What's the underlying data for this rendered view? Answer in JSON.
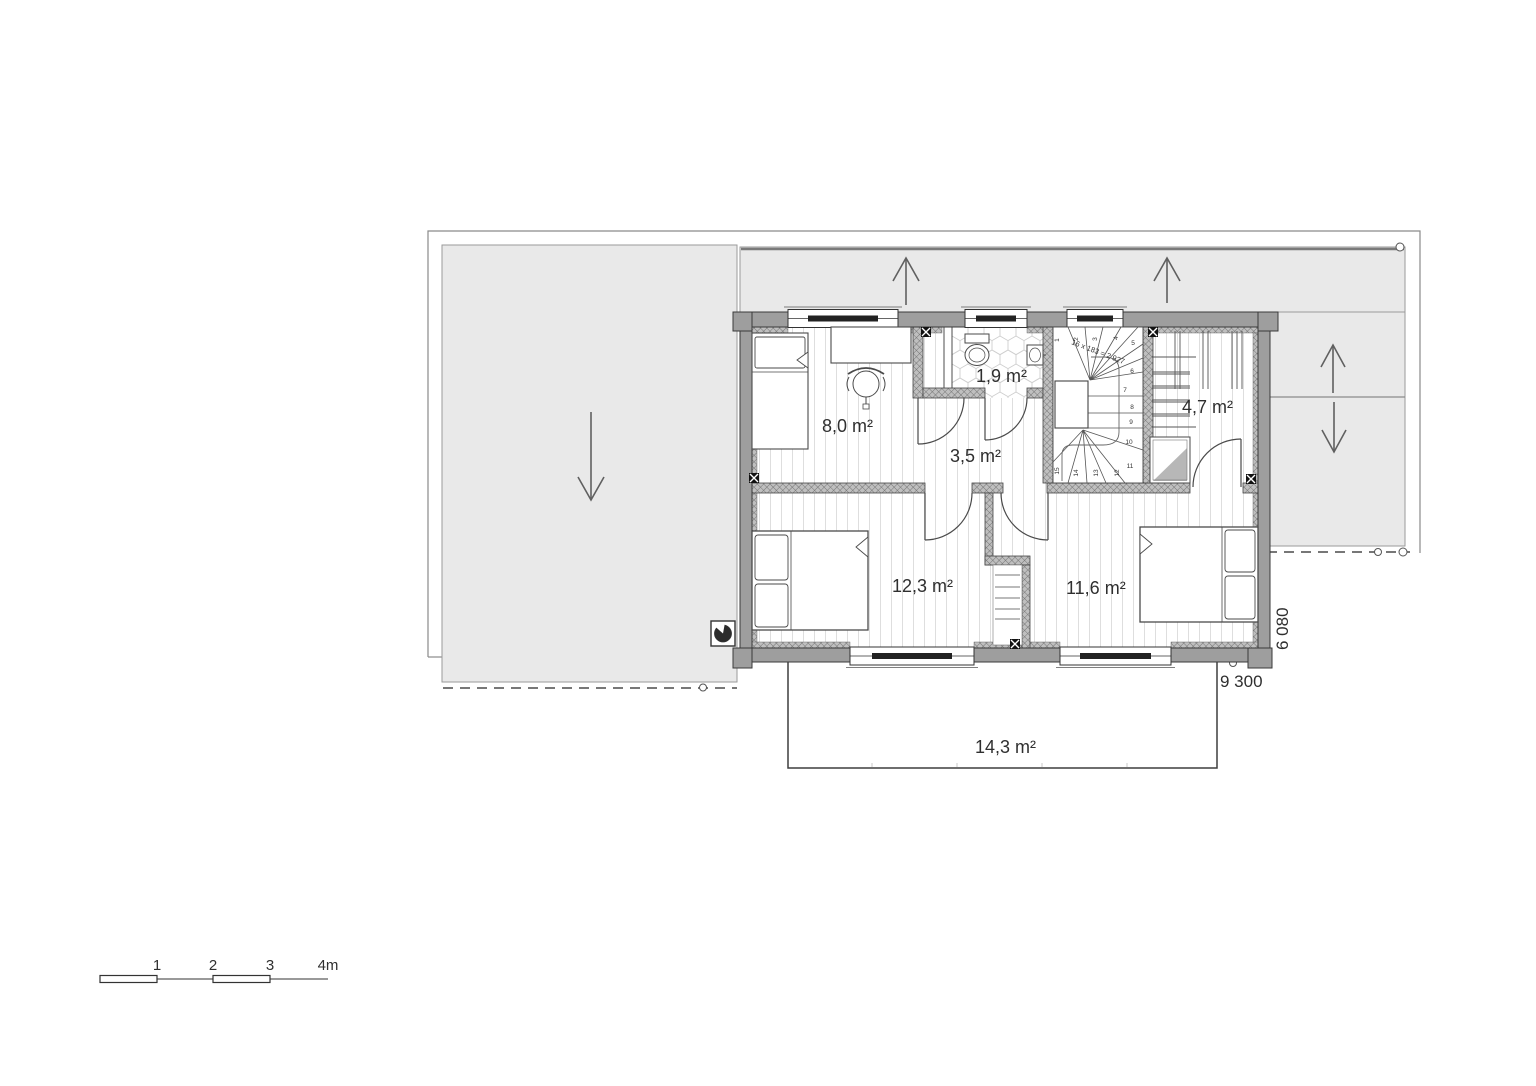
{
  "drawing": {
    "type": "floor-plan-upper-storey",
    "rooms": [
      {
        "id": "bedroom-small",
        "label": "8,0 m²"
      },
      {
        "id": "bathroom",
        "label": "1,9 m²"
      },
      {
        "id": "hallway",
        "label": "3,5 m²"
      },
      {
        "id": "storage-room",
        "label": "4,7 m²"
      },
      {
        "id": "bedroom-left",
        "label": "12,3 m²"
      },
      {
        "id": "bedroom-right",
        "label": "11,6 m²"
      },
      {
        "id": "balcony",
        "label": "14,3 m²"
      }
    ],
    "stairs": {
      "formula": "16 x 183 = 2 927",
      "steps": [
        "1",
        "2",
        "3",
        "4",
        "5",
        "6",
        "7",
        "8",
        "9",
        "10",
        "11",
        "12",
        "13",
        "14",
        "15"
      ]
    },
    "dimensions": {
      "width": "9 300",
      "height": "6 080"
    },
    "scale_bar": {
      "labels": [
        "1",
        "2",
        "3",
        "4m"
      ]
    },
    "colors": {
      "roof_fill": "#e9e9e9",
      "wall_fill": "#9e9e9e",
      "line": "#3a3a3a",
      "text": "#2f2f2f"
    }
  }
}
